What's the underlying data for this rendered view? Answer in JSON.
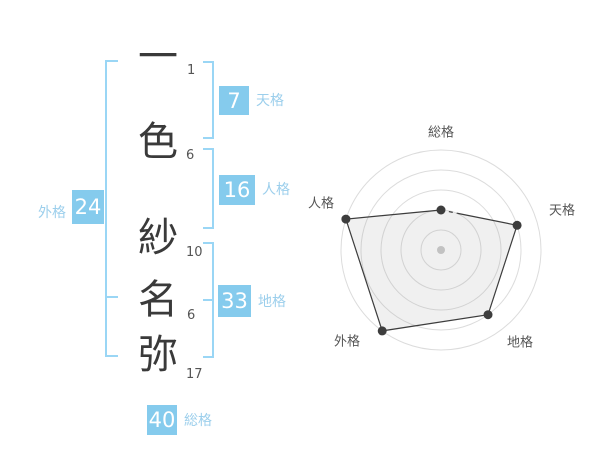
{
  "page": {
    "background": "#ffffff"
  },
  "name_panel": {
    "characters": [
      {
        "char": "一",
        "strokes": "1"
      },
      {
        "char": "色",
        "strokes": "6"
      },
      {
        "char": "紗",
        "strokes": "10"
      },
      {
        "char": "名",
        "strokes": "6"
      },
      {
        "char": "弥",
        "strokes": "17"
      }
    ],
    "scores": [
      {
        "label": "天格",
        "value": "7"
      },
      {
        "label": "人格",
        "value": "16"
      },
      {
        "label": "地格",
        "value": "33"
      },
      {
        "label": "外格",
        "value": "24"
      },
      {
        "label": "総格",
        "value": "40"
      }
    ]
  },
  "chart_data": {
    "type": "radar",
    "axes": [
      "総格",
      "天格",
      "地格",
      "外格",
      "人格"
    ],
    "values": [
      2,
      4,
      4,
      5,
      5
    ],
    "max": 5,
    "rings": 5,
    "start_angle_deg": -90,
    "clockwise": true,
    "center_dot": true,
    "partial_dashed_edge": "総格-天格",
    "colors": {
      "ring": "#dcdcdc",
      "polygon_stroke": "#3d3d3d",
      "polygon_fill": "rgba(150,150,150,0.14)",
      "vertex": "#3d3d3d",
      "center_dot": "#c2c2c2",
      "axis_label": "#555555"
    }
  },
  "colors": {
    "box_blue": "#85cbed",
    "label_blue": "#9ccfec",
    "bracket_blue": "#9ad6f5",
    "kanji_color": "#3a3a3a",
    "stroke_number_color": "#555555"
  }
}
